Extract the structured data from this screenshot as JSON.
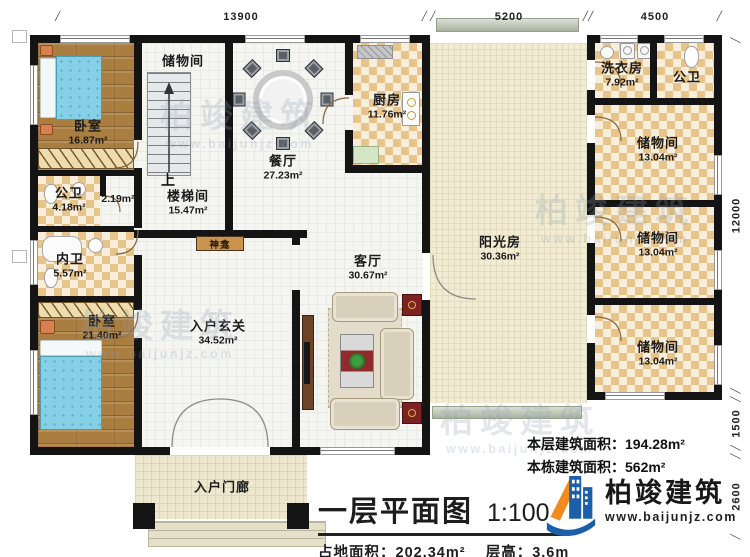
{
  "plan": {
    "title": "一层平面图",
    "scale": "1:100",
    "footprint_label": "占地面积：",
    "footprint_value": "202.34m²",
    "floor_height_label": "层高：",
    "floor_height_value": "3.6m",
    "floor_area_label": "本层建筑面积：",
    "floor_area_value": "194.28m²",
    "building_area_label": "本栋建筑面积：",
    "building_area_value": "562m²"
  },
  "dimensions": {
    "top_13900": "13900",
    "top_5200": "5200",
    "top_4500": "4500",
    "right_12000": "12000",
    "right_1500": "1500",
    "right_2600": "2600"
  },
  "rooms": {
    "bedroom_top": {
      "name": "卧室",
      "area": "16.87m²"
    },
    "storage_top": {
      "name": "储物间"
    },
    "dining": {
      "name": "餐厅",
      "area": "27.23m²"
    },
    "kitchen": {
      "name": "厨房",
      "area": "11.76m²"
    },
    "bath_left": {
      "name": "公卫",
      "area": "4.18m²"
    },
    "under_stair_area": "2.19m²",
    "stair_hall": {
      "name": "楼梯间",
      "area": "15.47m²"
    },
    "shrine": {
      "name": "神龛"
    },
    "inner_bath": {
      "name": "内卫",
      "area": "5.57m²"
    },
    "bedroom_bottom": {
      "name": "卧室",
      "area": "21.40m²"
    },
    "foyer": {
      "name": "入户玄关",
      "area": "34.52m²"
    },
    "living": {
      "name": "客厅",
      "area": "30.67m²"
    },
    "sunroom": {
      "name": "阳光房",
      "area": "30.36m²"
    },
    "laundry": {
      "name": "洗衣房",
      "area": "7.92m²"
    },
    "bath_right": {
      "name": "公卫"
    },
    "storage_r1": {
      "name": "储物间",
      "area": "13.04m²"
    },
    "storage_r2": {
      "name": "储物间",
      "area": "13.04m²"
    },
    "storage_r3": {
      "name": "储物间",
      "area": "13.04m²"
    },
    "porch": {
      "name": "入户门廊"
    }
  },
  "stairs_up": "上",
  "branding": {
    "company": "柏竣建筑",
    "website": "www.baijunjz.com"
  },
  "watermark": {
    "text": "柏竣建筑",
    "website": "www.baijunjz.com"
  },
  "colors": {
    "logo_blue": "#1a5fa8",
    "logo_orange": "#f28b1f",
    "wall": "#141414",
    "tile": "#e7c489",
    "bed": "#85d0e6"
  }
}
